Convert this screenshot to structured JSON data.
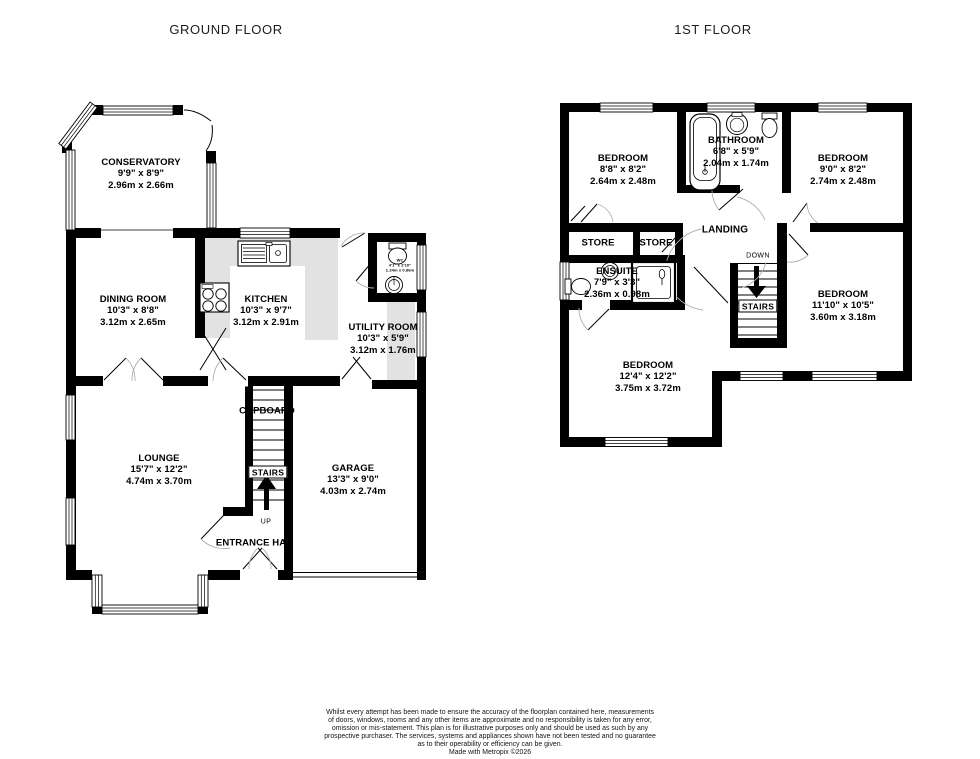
{
  "header": {
    "ground_floor_title": "GROUND FLOOR",
    "first_floor_title": "1ST FLOOR"
  },
  "ground_floor": {
    "conservatory": {
      "name": "CONSERVATORY",
      "imperial": "9'9\" x 8'9\"",
      "metric": "2.96m x 2.66m"
    },
    "dining_room": {
      "name": "DINING ROOM",
      "imperial": "10'3\" x 8'8\"",
      "metric": "3.12m x 2.65m"
    },
    "kitchen": {
      "name": "KITCHEN",
      "imperial": "10'3\" x 9'7\"",
      "metric": "3.12m x 2.91m"
    },
    "wc": {
      "name": "WC",
      "imperial": "4'1\" x 2'10\"",
      "metric": "1.24m x 0.86m"
    },
    "utility_room": {
      "name": "UTILITY ROOM",
      "imperial": "10'3\" x 5'9\"",
      "metric": "3.12m x 1.76m"
    },
    "lounge": {
      "name": "LOUNGE",
      "imperial": "15'7\" x 12'2\"",
      "metric": "4.74m x 3.70m"
    },
    "garage": {
      "name": "GARAGE",
      "imperial": "13'3\" x 9'0\"",
      "metric": "4.03m x 2.74m"
    },
    "cupboard_label": "CUPBOARD",
    "stairs_label": "STAIRS",
    "up_label": "UP",
    "entrance_label": "ENTRANCE HAL"
  },
  "first_floor": {
    "bedroom_top_left": {
      "name": "BEDROOM",
      "imperial": "8'8\" x 8'2\"",
      "metric": "2.64m x 2.48m"
    },
    "bathroom": {
      "name": "BATHROOM",
      "imperial": "6'8\" x 5'9\"",
      "metric": "2.04m x 1.74m"
    },
    "bedroom_top_right": {
      "name": "BEDROOM",
      "imperial": "9'0\" x 8'2\"",
      "metric": "2.74m x 2.48m"
    },
    "landing_label": "LANDING",
    "store_left_label": "STORE",
    "store_right_label": "STORE",
    "ensuite": {
      "name": "ENSUITE",
      "imperial": "7'9\" x 3'3\"",
      "metric": "2.36m x 0.98m"
    },
    "down_label": "DOWN",
    "stairs_label": "STAIRS",
    "bedroom_right": {
      "name": "BEDROOM",
      "imperial": "11'10\" x 10'5\"",
      "metric": "3.60m x 3.18m"
    },
    "bedroom_bottom_left": {
      "name": "BEDROOM",
      "imperial": "12'4\" x 12'2\"",
      "metric": "3.75m x 3.72m"
    }
  },
  "footer": {
    "disclaimer_lines": [
      "Whilst every attempt has been made to ensure the accuracy of the floorplan contained here, measurements",
      "of doors, windows, rooms and any other items are approximate and no responsibility is taken for any error,",
      "omission or mis-statement. This plan is for illustrative purposes only and should be used as such by any",
      "prospective purchaser. The services, systems and appliances shown have not been tested and no guarantee",
      "as to their operability or efficiency can be given."
    ],
    "credit": "Made with Metropix ©2026"
  },
  "colors": {
    "wall": "#000000",
    "counter": "#e2e2e2",
    "door_arc": "#b0b0b0"
  }
}
